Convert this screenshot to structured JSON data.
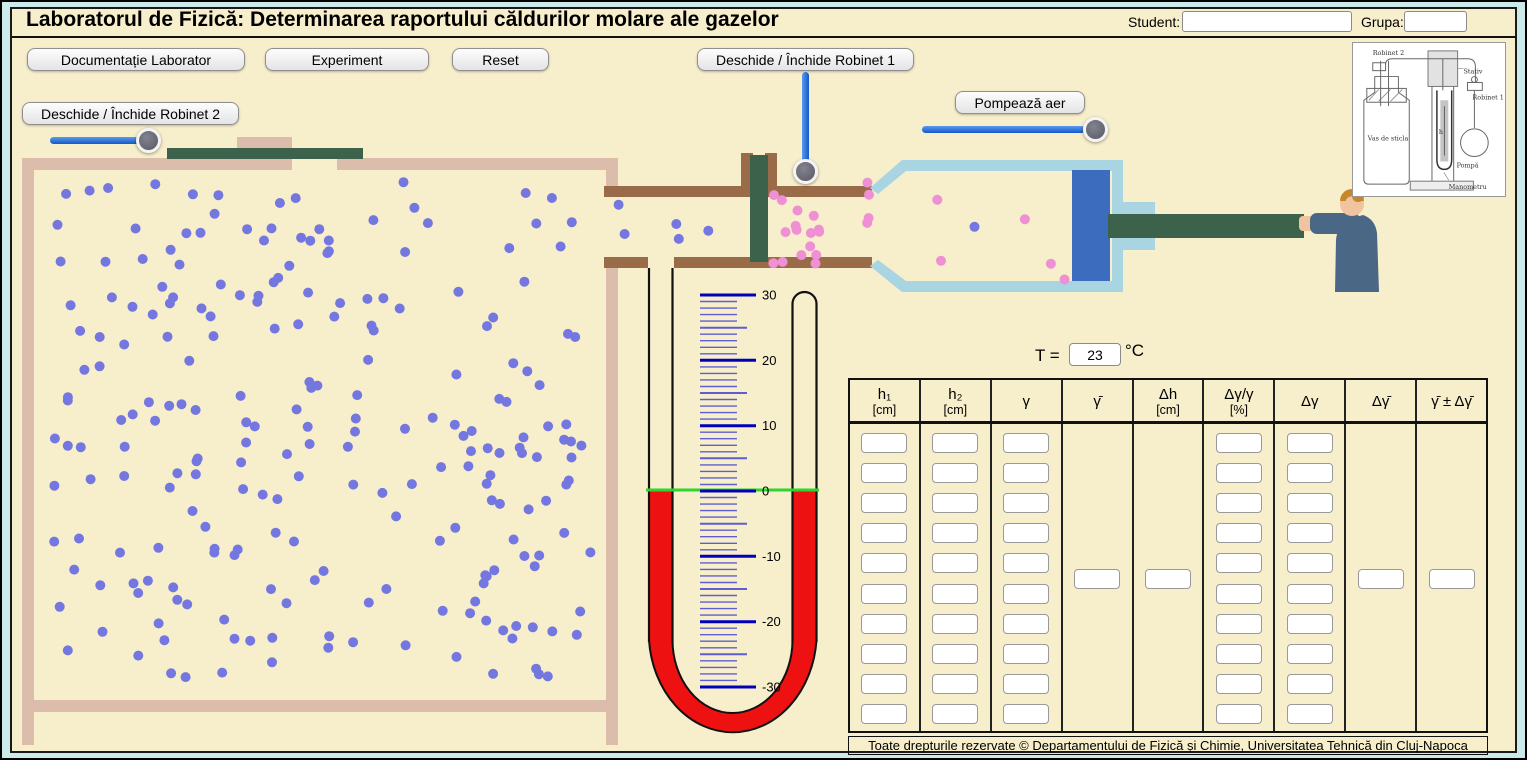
{
  "page": {
    "title": "Laboratorul de Fizică: Determinarea raportului căldurilor molare ale gazelor",
    "footer": "Toate drepturile rezervate © Departamentului de Fizică și Chimie, Universitatea Tehnică din Cluj-Napoca"
  },
  "header_fields": {
    "student_label": "Student:",
    "student_value": "",
    "grupa_label": "Grupa:",
    "grupa_value": ""
  },
  "buttons": {
    "documentation": "Documentație Laborator",
    "experiment": "Experiment",
    "reset": "Reset",
    "robinet1": "Deschide / Închide Robinet 1",
    "robinet2": "Deschide / Închide Robinet 2",
    "pump": "Pompează aer"
  },
  "temperature": {
    "label": "T =",
    "value": "23",
    "unit": "°C"
  },
  "manometer": {
    "top_value": 30,
    "bottom_value": -30,
    "major_every": 10,
    "half_every": 5,
    "major_labels": [
      "30",
      "20",
      "10",
      "0",
      "-10",
      "-20",
      "-30"
    ]
  },
  "table": {
    "rows": 10,
    "columns": [
      {
        "label": "h₁",
        "unit": "[cm]",
        "inputs": "rows"
      },
      {
        "label": "h₂",
        "unit": "[cm]",
        "inputs": "rows"
      },
      {
        "label": "γ",
        "unit": "",
        "inputs": "rows"
      },
      {
        "label": "γ̄",
        "unit": "",
        "inputs": "single"
      },
      {
        "label": "Δh",
        "unit": "[cm]",
        "inputs": "single"
      },
      {
        "label": "Δγ/γ",
        "unit": "[%]",
        "inputs": "rows"
      },
      {
        "label": "Δγ",
        "unit": "",
        "inputs": "rows"
      },
      {
        "label": "Δγ̄",
        "unit": "",
        "inputs": "single"
      },
      {
        "label": "γ̄ ± Δγ̄",
        "unit": "",
        "inputs": "single"
      }
    ]
  },
  "apparatus_figure": {
    "labels": {
      "robinet2": "Robinet 2",
      "stativ": "Stativ",
      "robinet1": "Robinet 1",
      "vas": "Vas de sticla",
      "pompa": "Pompă",
      "manometru": "Manometru",
      "h": "h"
    }
  },
  "particles": {
    "seed": 20,
    "radius": 5,
    "regions": [
      {
        "name": "tank-gas",
        "color": "#7577e0",
        "count": 230,
        "x": 44,
        "y": 182,
        "w": 548,
        "h": 500
      },
      {
        "name": "pipe-gas",
        "color": "#7577e0",
        "count": 5,
        "x": 618,
        "y": 202,
        "w": 118,
        "h": 48
      },
      {
        "name": "valve-outlet-gas",
        "color": "#ef8fd4",
        "count": 16,
        "x": 768,
        "y": 194,
        "w": 58,
        "h": 70
      },
      {
        "name": "syringe-gas",
        "color": "#ef8fd4",
        "count": 9,
        "x": 840,
        "y": 176,
        "w": 230,
        "h": 104
      },
      {
        "name": "syringe-blue-gas",
        "color": "#7577e0",
        "count": 1,
        "x": 972,
        "y": 226,
        "w": 12,
        "h": 12
      }
    ]
  },
  "colors": {
    "panel_bg": "#f7eecb",
    "frame_bg": "#cdeaea",
    "tank_wall": "#dcbcaa",
    "pipe": "#9a6b48",
    "valve": "#3d624c",
    "syringe": "#a9d5e3",
    "piston": "#3b6cbe",
    "rod": "#3d624c",
    "liquid": "#ee1111",
    "zero_line": "#2ed52e",
    "tick_major": "#0000bb",
    "tick_minor": "#5e5ed2",
    "slider": "#1f63d6",
    "gas_blue": "#7577e0",
    "gas_pink": "#ef8fd4",
    "suit": "#4a6785",
    "skin": "#f0c49e",
    "hair": "#c8862c"
  }
}
